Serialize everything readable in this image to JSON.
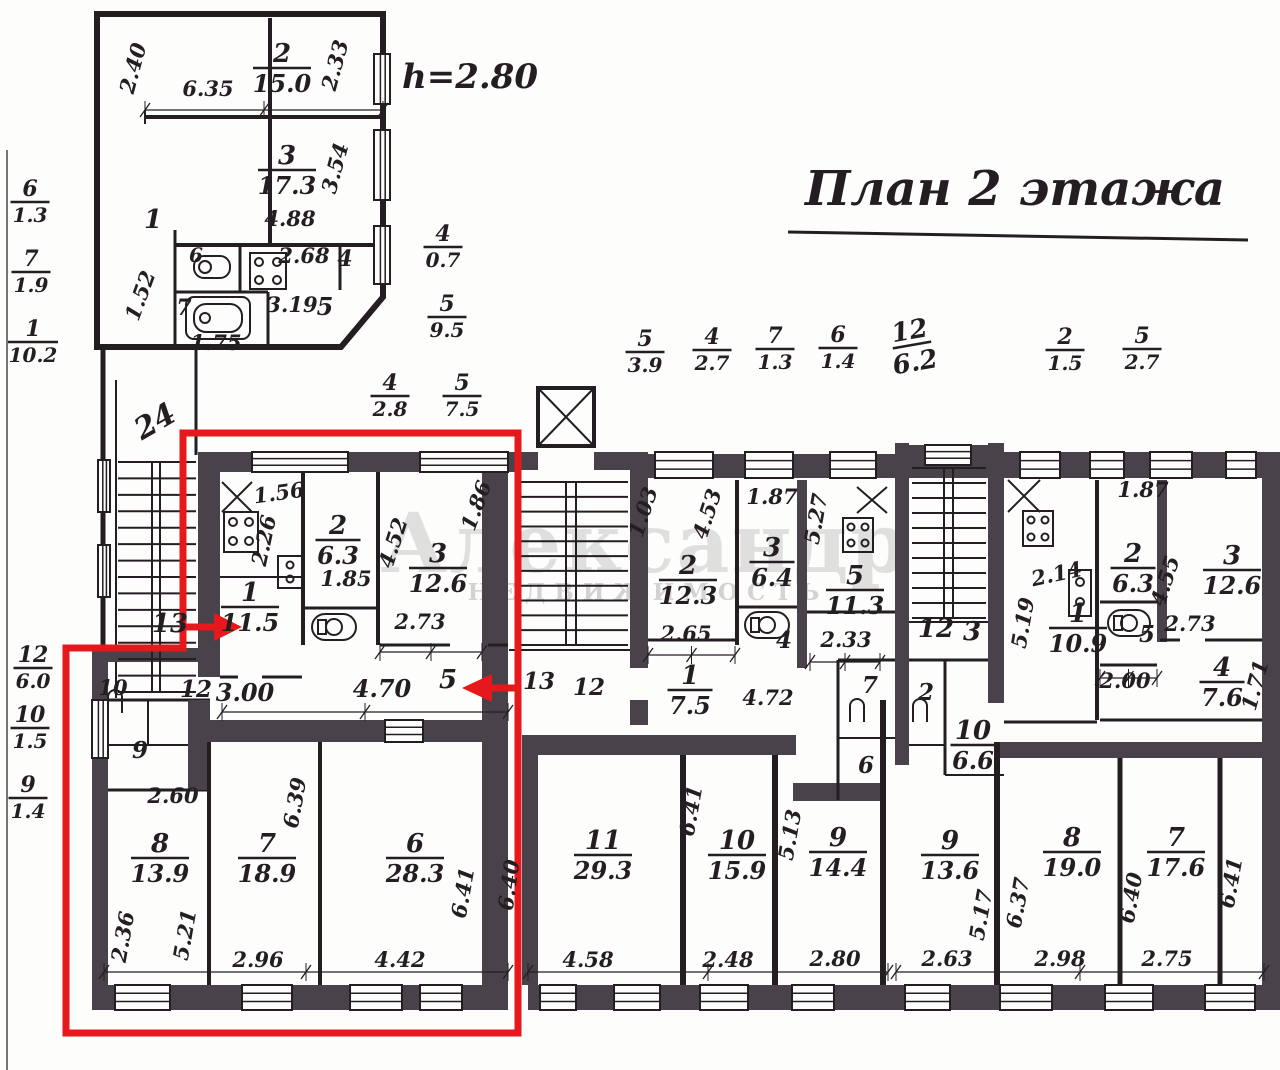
{
  "meta": {
    "sheet_title": "План 2 этажа",
    "height_note": "h=2.80"
  },
  "watermark": {
    "line1": "Александр",
    "line2": "НЕДВИЖИМОСТЬ"
  },
  "highlight": {
    "color": "#e5191c"
  },
  "palette": {
    "ink": "#241e23",
    "wall": "#4a424a",
    "paper": "#fdfdfc"
  },
  "room_fractions": [
    {
      "num": "2",
      "den": "15.0",
      "x": 282,
      "y": 68
    },
    {
      "num": "3",
      "den": "17.3",
      "x": 287,
      "y": 170
    },
    {
      "num": "2",
      "den": "6.3",
      "x": 338,
      "y": 540
    },
    {
      "num": "3",
      "den": "12.6",
      "x": 438,
      "y": 568
    },
    {
      "num": "1",
      "den": "11.5",
      "x": 250,
      "y": 607
    },
    {
      "num": "8",
      "den": "13.9",
      "x": 160,
      "y": 858
    },
    {
      "num": "7",
      "den": "18.9",
      "x": 267,
      "y": 858
    },
    {
      "num": "6",
      "den": "28.3",
      "x": 415,
      "y": 858
    },
    {
      "num": "2",
      "den": "12.3",
      "x": 688,
      "y": 580
    },
    {
      "num": "3",
      "den": "6.4",
      "x": 772,
      "y": 562
    },
    {
      "num": "5",
      "den": "11.3",
      "x": 855,
      "y": 590
    },
    {
      "num": "1",
      "den": "7.5",
      "x": 690,
      "y": 690
    },
    {
      "num": "11",
      "den": "29.3",
      "x": 603,
      "y": 855
    },
    {
      "num": "10",
      "den": "15.9",
      "x": 737,
      "y": 855
    },
    {
      "num": "9",
      "den": "14.4",
      "x": 838,
      "y": 852
    },
    {
      "num": "1",
      "den": "10.9",
      "x": 1078,
      "y": 628
    },
    {
      "num": "2",
      "den": "6.3",
      "x": 1133,
      "y": 568
    },
    {
      "num": "3",
      "den": "12.6",
      "x": 1232,
      "y": 570
    },
    {
      "num": "4",
      "den": "7.6",
      "x": 1222,
      "y": 682
    },
    {
      "num": "9",
      "den": "13.6",
      "x": 950,
      "y": 855
    },
    {
      "num": "8",
      "den": "19.0",
      "x": 1072,
      "y": 852
    },
    {
      "num": "7",
      "den": "17.6",
      "x": 1176,
      "y": 852
    },
    {
      "num": "10",
      "den": "6.6",
      "x": 973,
      "y": 745
    }
  ],
  "stat_fractions": [
    {
      "num": "6",
      "den": "1.3",
      "x": 30,
      "y": 202
    },
    {
      "num": "7",
      "den": "1.9",
      "x": 31,
      "y": 272
    },
    {
      "num": "1",
      "den": "10.2",
      "x": 33,
      "y": 342
    },
    {
      "num": "12",
      "den": "6.0",
      "x": 33,
      "y": 668
    },
    {
      "num": "10",
      "den": "1.5",
      "x": 30,
      "y": 728
    },
    {
      "num": "9",
      "den": "1.4",
      "x": 28,
      "y": 798
    },
    {
      "num": "4",
      "den": "0.7",
      "x": 443,
      "y": 247
    },
    {
      "num": "5",
      "den": "9.5",
      "x": 447,
      "y": 317
    },
    {
      "num": "4",
      "den": "2.8",
      "x": 390,
      "y": 396
    },
    {
      "num": "5",
      "den": "7.5",
      "x": 462,
      "y": 396
    },
    {
      "num": "5",
      "den": "3.9",
      "x": 645,
      "y": 352
    },
    {
      "num": "4",
      "den": "2.7",
      "x": 712,
      "y": 350
    },
    {
      "num": "7",
      "den": "1.3",
      "x": 775,
      "y": 349
    },
    {
      "num": "6",
      "den": "1.4",
      "x": 838,
      "y": 348
    },
    {
      "num": "12",
      "den": "6.2",
      "x": 912,
      "y": 345,
      "r": -10,
      "s": 26
    },
    {
      "num": "2",
      "den": "1.5",
      "x": 1065,
      "y": 350
    },
    {
      "num": "5",
      "den": "2.7",
      "x": 1142,
      "y": 349
    }
  ],
  "dims": [
    {
      "t": "2.40",
      "x": 140,
      "y": 70,
      "r": -75
    },
    {
      "t": "6.35",
      "x": 208,
      "y": 96
    },
    {
      "t": "2.33",
      "x": 342,
      "y": 67,
      "r": -75
    },
    {
      "t": "3.54",
      "x": 342,
      "y": 170,
      "r": -75
    },
    {
      "t": "4.88",
      "x": 290,
      "y": 226
    },
    {
      "t": "2.68",
      "x": 304,
      "y": 263
    },
    {
      "t": "3.19",
      "x": 292,
      "y": 312
    },
    {
      "t": "5",
      "x": 325,
      "y": 315,
      "s": 24
    },
    {
      "t": "4",
      "x": 345,
      "y": 266,
      "s": 22
    },
    {
      "t": "1",
      "x": 153,
      "y": 228,
      "s": 26
    },
    {
      "t": "6",
      "x": 196,
      "y": 262,
      "s": 20
    },
    {
      "t": "7",
      "x": 184,
      "y": 315,
      "s": 22
    },
    {
      "t": "1.52",
      "x": 147,
      "y": 298,
      "r": -70
    },
    {
      "t": "1.75",
      "x": 216,
      "y": 350
    },
    {
      "t": "24",
      "x": 160,
      "y": 430,
      "r": -30,
      "s": 30
    },
    {
      "t": "1.56",
      "x": 280,
      "y": 500,
      "r": -8
    },
    {
      "t": "2.26",
      "x": 271,
      "y": 542,
      "r": -78
    },
    {
      "t": "4.52",
      "x": 400,
      "y": 545,
      "r": -72
    },
    {
      "t": "1.86",
      "x": 483,
      "y": 508,
      "r": -70
    },
    {
      "t": "1.85",
      "x": 346,
      "y": 586
    },
    {
      "t": "2.73",
      "x": 420,
      "y": 629
    },
    {
      "t": "3.00",
      "x": 245,
      "y": 701,
      "s": 24
    },
    {
      "t": "4.70",
      "x": 382,
      "y": 697,
      "s": 24
    },
    {
      "t": "13",
      "x": 170,
      "y": 632,
      "s": 26
    },
    {
      "t": "5",
      "x": 448,
      "y": 688,
      "s": 26
    },
    {
      "t": "12",
      "x": 196,
      "y": 697,
      "s": 23
    },
    {
      "t": "10",
      "x": 113,
      "y": 695,
      "s": 21
    },
    {
      "t": "9",
      "x": 140,
      "y": 758,
      "s": 23
    },
    {
      "t": "2.60",
      "x": 173,
      "y": 803
    },
    {
      "t": "2.36",
      "x": 130,
      "y": 938,
      "r": -80
    },
    {
      "t": "5.21",
      "x": 192,
      "y": 936,
      "r": -80
    },
    {
      "t": "6.39",
      "x": 302,
      "y": 804,
      "r": -80
    },
    {
      "t": "2.96",
      "x": 258,
      "y": 967
    },
    {
      "t": "6.41",
      "x": 470,
      "y": 894,
      "r": -80
    },
    {
      "t": "4.42",
      "x": 400,
      "y": 967
    },
    {
      "t": "6.40",
      "x": 516,
      "y": 886,
      "r": -82
    },
    {
      "t": "13",
      "x": 539,
      "y": 689,
      "s": 23
    },
    {
      "t": "12",
      "x": 589,
      "y": 695,
      "s": 23
    },
    {
      "t": "1.03",
      "x": 650,
      "y": 514,
      "r": -72
    },
    {
      "t": "4.53",
      "x": 714,
      "y": 516,
      "r": -72
    },
    {
      "t": "1.87",
      "x": 772,
      "y": 504
    },
    {
      "t": "5.27",
      "x": 823,
      "y": 520,
      "r": -80
    },
    {
      "t": "2.65",
      "x": 686,
      "y": 641
    },
    {
      "t": "2.33",
      "x": 846,
      "y": 647
    },
    {
      "t": "4",
      "x": 784,
      "y": 648,
      "s": 23
    },
    {
      "t": "4.72",
      "x": 768,
      "y": 705
    },
    {
      "t": "7",
      "x": 870,
      "y": 693,
      "s": 23
    },
    {
      "t": "6",
      "x": 866,
      "y": 773,
      "s": 23
    },
    {
      "t": "5.13",
      "x": 797,
      "y": 836,
      "r": -80
    },
    {
      "t": "6.41",
      "x": 698,
      "y": 812,
      "r": -80
    },
    {
      "t": "4.58",
      "x": 588,
      "y": 967
    },
    {
      "t": "2.48",
      "x": 728,
      "y": 967
    },
    {
      "t": "2.80",
      "x": 835,
      "y": 966
    },
    {
      "t": "12",
      "x": 936,
      "y": 637,
      "s": 26
    },
    {
      "t": "3",
      "x": 972,
      "y": 640,
      "s": 26
    },
    {
      "t": "2",
      "x": 926,
      "y": 700,
      "s": 23
    },
    {
      "t": "1.87",
      "x": 1143,
      "y": 497
    },
    {
      "t": "2.14",
      "x": 1058,
      "y": 581,
      "r": -12
    },
    {
      "t": "5.19",
      "x": 1030,
      "y": 624,
      "r": -80
    },
    {
      "t": "4.55",
      "x": 1172,
      "y": 583,
      "r": -72
    },
    {
      "t": "2.73",
      "x": 1190,
      "y": 631
    },
    {
      "t": "5",
      "x": 1147,
      "y": 642,
      "s": 23
    },
    {
      "t": "2.00",
      "x": 1125,
      "y": 688
    },
    {
      "t": "1.71",
      "x": 1262,
      "y": 687,
      "r": -75
    },
    {
      "t": "5.17",
      "x": 988,
      "y": 916,
      "r": -80
    },
    {
      "t": "6.37",
      "x": 1025,
      "y": 904,
      "r": -80
    },
    {
      "t": "6.40",
      "x": 1138,
      "y": 899,
      "r": -80
    },
    {
      "t": "6.41",
      "x": 1238,
      "y": 884,
      "r": -80
    },
    {
      "t": "2.63",
      "x": 947,
      "y": 966
    },
    {
      "t": "2.98",
      "x": 1060,
      "y": 966
    },
    {
      "t": "2.75",
      "x": 1167,
      "y": 966
    }
  ]
}
